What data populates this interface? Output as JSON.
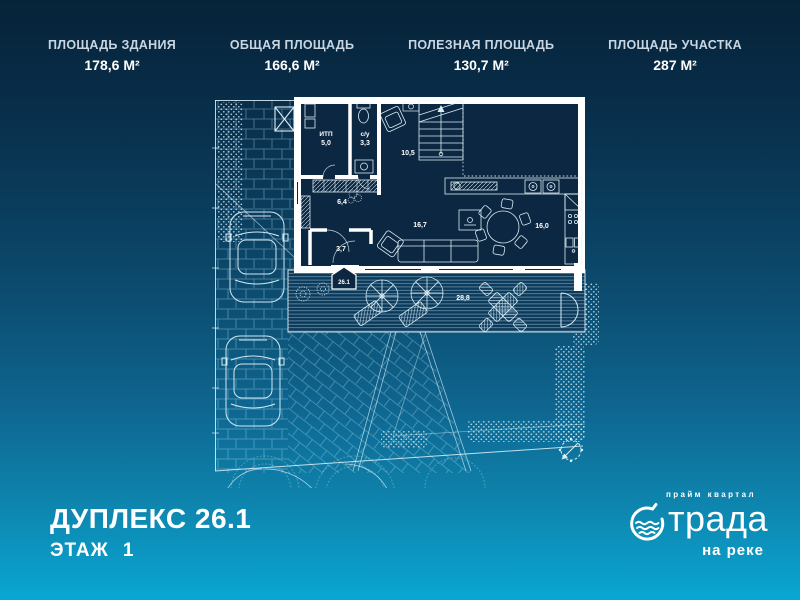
{
  "header": {
    "stats": [
      {
        "label": "ПЛОЩАДЬ ЗДАНИЯ",
        "value": "178,6 М²"
      },
      {
        "label": "ОБЩАЯ ПЛОЩАДЬ",
        "value": "166,6 М²"
      },
      {
        "label": "ПОЛЕЗНАЯ ПЛОЩАДЬ",
        "value": "130,7 М²"
      },
      {
        "label": "ПЛОЩАДЬ УЧАСТКА",
        "value": "287 М²"
      }
    ]
  },
  "plan": {
    "rooms": [
      {
        "id": "itp",
        "name": "ИТП",
        "area": "5,0"
      },
      {
        "id": "bathroom",
        "name": "с/у",
        "area": "3,3"
      },
      {
        "id": "hall",
        "name": "",
        "area": "10,5"
      },
      {
        "id": "corridor",
        "name": "",
        "area": "6,4"
      },
      {
        "id": "storage",
        "name": "",
        "area": "3,7"
      },
      {
        "id": "living",
        "name": "",
        "area": "16,7"
      },
      {
        "id": "kitchen",
        "name": "",
        "area": "16,0"
      },
      {
        "id": "terrace",
        "name": "",
        "area": "28,8"
      }
    ],
    "entrance_tag": "26.1"
  },
  "footer": {
    "title": "ДУПЛЕКС 26.1",
    "floor_label": "ЭТАЖ",
    "floor_value": "1"
  },
  "logo": {
    "tagline": "прайм квартал",
    "name": "трада",
    "subtitle": "на реке"
  },
  "colors": {
    "bg_top": "#062339",
    "bg_bottom": "#09a6d2",
    "line": "#ffffff",
    "interior": "#0c2742"
  }
}
